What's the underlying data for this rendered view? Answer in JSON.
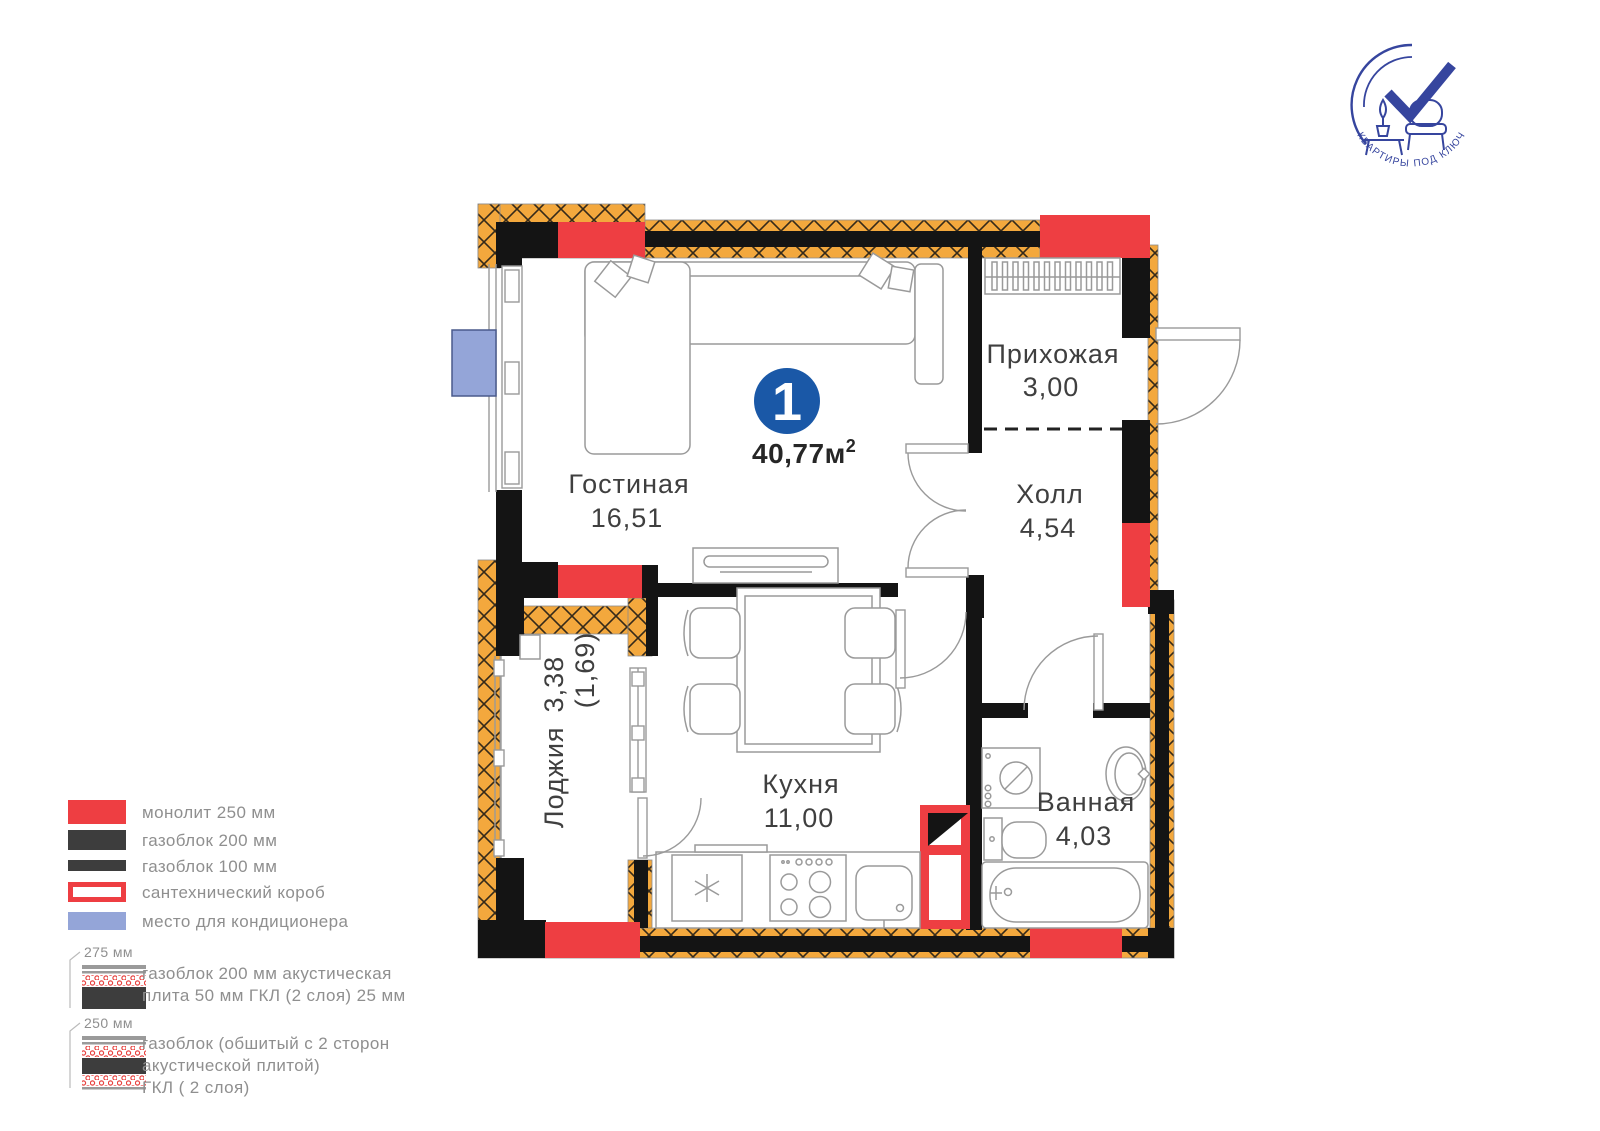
{
  "logo": {
    "arc_text": "КВАРТИРЫ ПОД КЛЮЧ ",
    "brand": "BIG+"
  },
  "badge": {
    "number": "1",
    "area": "40,77м",
    "sup": "2"
  },
  "rooms": [
    {
      "name": "Гостиная",
      "area": "16,51"
    },
    {
      "name": "Прихожая",
      "area": "3,00"
    },
    {
      "name": "Холл",
      "area": "4,54"
    },
    {
      "name": "Кухня",
      "area": "11,00"
    },
    {
      "name": "Ванная",
      "area": "4,03"
    },
    {
      "name": "Лоджия",
      "area": "3,38",
      "area2": "(1,69)"
    }
  ],
  "legend": {
    "items": [
      {
        "label": "монолит 250 мм",
        "type": "red"
      },
      {
        "label": "газоблок 200 мм",
        "type": "dark"
      },
      {
        "label": "газоблок 100 мм",
        "type": "dark-thin"
      },
      {
        "label": "сантехнический короб",
        "type": "red-outline"
      },
      {
        "label": "место для кондиционера",
        "type": "blue"
      }
    ],
    "acoustic": [
      {
        "size": "275 мм",
        "lines": [
          "газоблок 200 мм акустическая",
          "плита 50 мм ГКЛ (2 слоя) 25 мм"
        ]
      },
      {
        "size": "250 мм",
        "lines": [
          "газоблок (обшитый с 2 сторон",
          "акустической плитой)",
          "ГКЛ ( 2 слоя)"
        ]
      }
    ]
  },
  "colors": {
    "monolith_red": "#ee3e42",
    "wall_black": "#141414",
    "hatch_orange": "#f3a83d",
    "ac_blue": "#94a5d8",
    "badge_blue": "#1a58a7",
    "logo_blue": "#36459e",
    "label_gray": "#3f3f3f",
    "legend_text": "#8f8f8f",
    "legend_dark": "#3d3d3d",
    "furniture_gray": "#9a9a9a"
  }
}
